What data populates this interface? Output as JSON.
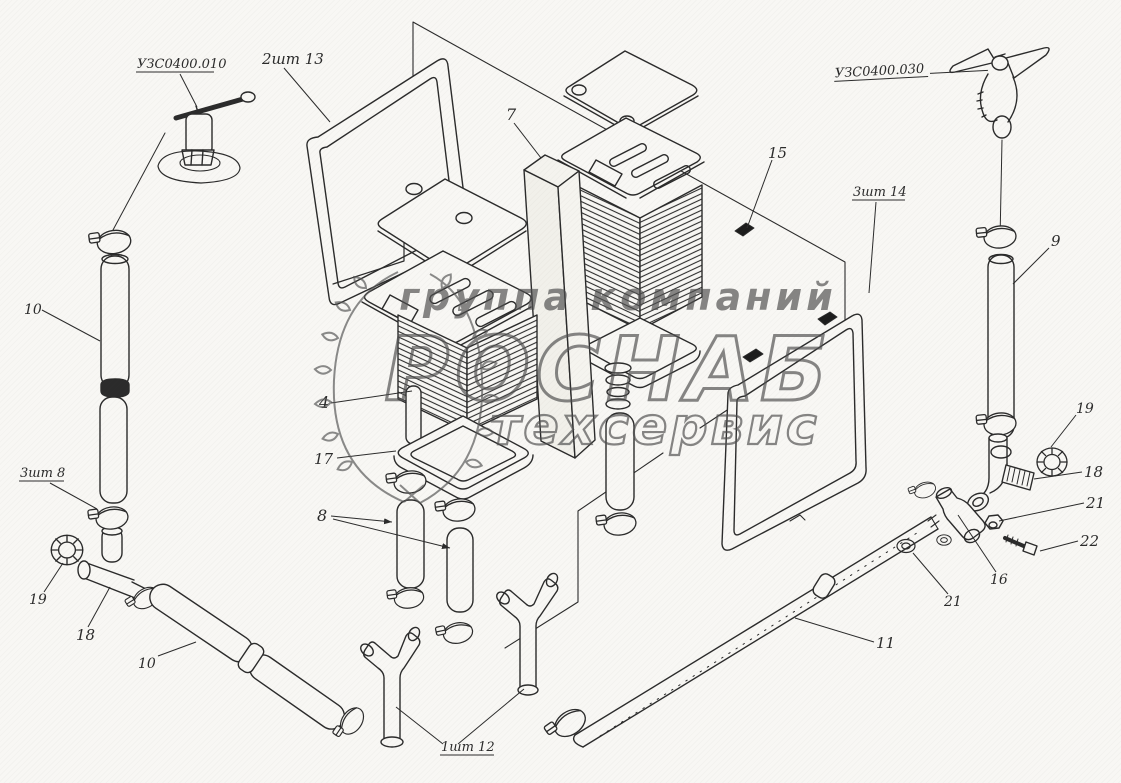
{
  "page": {
    "background": "#f8f7f4",
    "ink": "#2b2b2b",
    "watermark_color": "#565656"
  },
  "watermark": {
    "line1": "группа компаний",
    "line2": "РОСНАБ",
    "line3": "техсервис"
  },
  "callouts": {
    "part_code_left": "УЗС0400.010",
    "frame_left_qty": "2шт 13",
    "divider_panel": "7",
    "clip": "15",
    "frame_right_qty": "3шт 14",
    "part_code_right": "УЗС0400.030",
    "hose_right": "9",
    "hose_left_top": "10",
    "hose_qty": "3шт 8",
    "core": "4",
    "tray": "17",
    "hoses_mid": "8",
    "cap_left": "19",
    "tee_left": "18",
    "hose_bottom": "10",
    "wye_qty": "1шт 12",
    "pipe_long": "11",
    "cap_right": "19",
    "elbow_right": "18",
    "nut_right": "21",
    "bolt": "22",
    "tee_right": "16",
    "washer_lower": "21"
  }
}
